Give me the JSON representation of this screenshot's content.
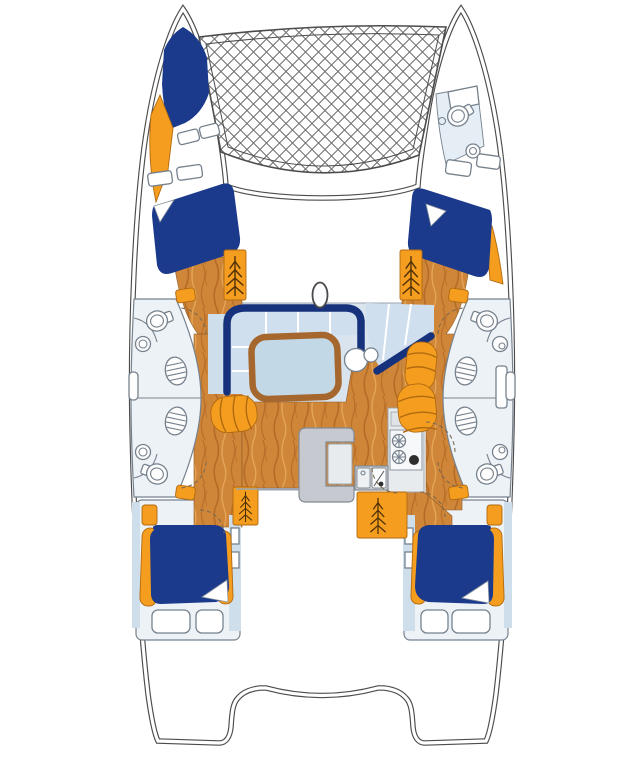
{
  "title": "Catamaran yacht interior floor plan (top-down view)",
  "palette": {
    "hullLine": "#4c4c4c",
    "netLine": "#6e6e6e",
    "navy": "#1c3a8c",
    "bandNavy": "#17327c",
    "orange": "#f49d1f",
    "orangeDark": "#b16a10",
    "stepLine": "#4e2f05",
    "wood": "#d08638",
    "woodStreak": "#a96121",
    "woodLight": "#e8ab60",
    "saloonBg": "#d9e4ef",
    "cushion": "#cfdfee",
    "paleBlue": "#cfdeeb",
    "fixtureBg": "#edf2f7",
    "fixtureLine": "#76828e",
    "counterGray": "#c6cad0",
    "counterLight": "#e8ebee",
    "tableTop": "#c3d8e6",
    "tableRim": "#a5672e",
    "knobBlack": "#2e2e2e",
    "wallLine": "#9aa5b1"
  },
  "components": {
    "net": "Bow trampoline net",
    "port_hull": "Port hull",
    "starboard_hull": "Starboard hull",
    "saloon": "Saloon with U-shaped settee and table",
    "settee": "U-shaped settee with navy backrest",
    "nav_seat": "Forward-facing seat cushions",
    "table": "Saloon table",
    "mast": "Mast base",
    "galley": "Galley with two-burner stove and double sink",
    "stove": "Two-burner stove",
    "sink": "Double galley sink",
    "counter": "Galley counter island",
    "stool": "Round seat",
    "port_forepeak_berth": "Port forepeak berth",
    "port_forward_berth": "Port forward double berth",
    "starboard_forward_berth": "Starboard forward double berth",
    "port_aft_berth": "Port aft double berth",
    "starboard_aft_berth": "Starboard aft double berth",
    "bow_head": "Starboard bow head with toilet and washbasin",
    "port_forward_head": "Port forward head",
    "port_aft_head": "Port aft head",
    "starboard_forward_head": "Starboard forward head",
    "starboard_aft_head": "Starboard aft head",
    "companionways": "Companionway steps",
    "cockpit": "Aft cockpit deck",
    "transom_windows": "Aft cabin stern windows"
  },
  "counts": {
    "double_berths": 5,
    "toilets": 5,
    "washbasins": 5,
    "companionway_steps": 4,
    "stove_burners": 2
  }
}
